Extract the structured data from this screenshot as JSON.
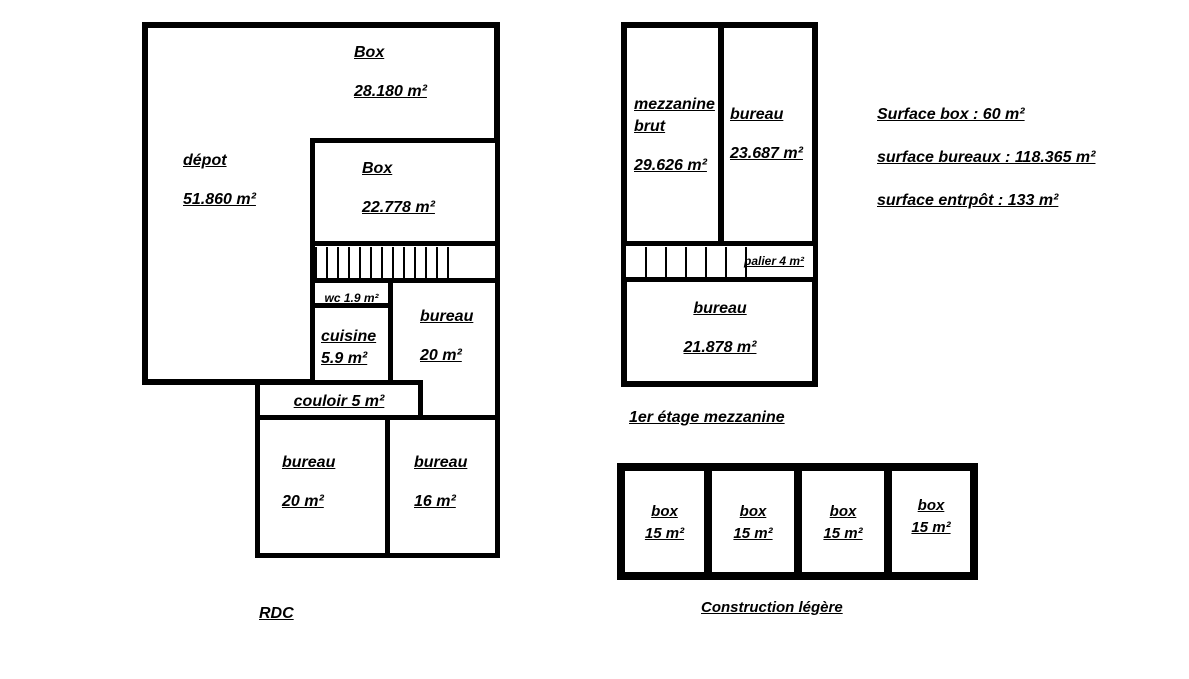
{
  "colors": {
    "wall": "#000000",
    "background": "#ffffff"
  },
  "summary": {
    "lines": [
      "Surface box : 60 m²",
      "surface bureaux : 118.365 m²",
      "surface entrpôt : 133 m²"
    ]
  },
  "rdc": {
    "title": "RDC",
    "rooms": {
      "box_top": {
        "name": "Box",
        "area": "28.180 m²"
      },
      "depot": {
        "name": "dépot",
        "area": "51.860 m²"
      },
      "box_inner": {
        "name": "Box",
        "area": "22.778 m²"
      },
      "wc": {
        "label": "wc 1.9 m²"
      },
      "cuisine": {
        "name": "cuisine",
        "area": "5.9 m²"
      },
      "bureau_top": {
        "name": "bureau",
        "area": "20 m²"
      },
      "couloir": {
        "label": "couloir 5 m²"
      },
      "bureau_bottom_left": {
        "name": "bureau",
        "area": "20 m²"
      },
      "bureau_bottom_right": {
        "name": "bureau",
        "area": "16 m²"
      }
    }
  },
  "mezzanine": {
    "title": "1er étage mezzanine",
    "rooms": {
      "mezzanine_brut": {
        "name": "mezzanine brut",
        "area": "29.626 m²"
      },
      "bureau_right": {
        "name": "bureau",
        "area": "23.687 m²"
      },
      "palier": {
        "label": "palier 4 m²"
      },
      "bureau_bottom": {
        "name": "bureau",
        "area": "21.878 m²"
      }
    }
  },
  "construction": {
    "title": "Construction légère",
    "boxes": [
      {
        "name": "box",
        "area": "15 m²"
      },
      {
        "name": "box",
        "area": "15 m²"
      },
      {
        "name": "box",
        "area": "15 m²"
      },
      {
        "name": "box",
        "area": "15 m²"
      }
    ]
  }
}
